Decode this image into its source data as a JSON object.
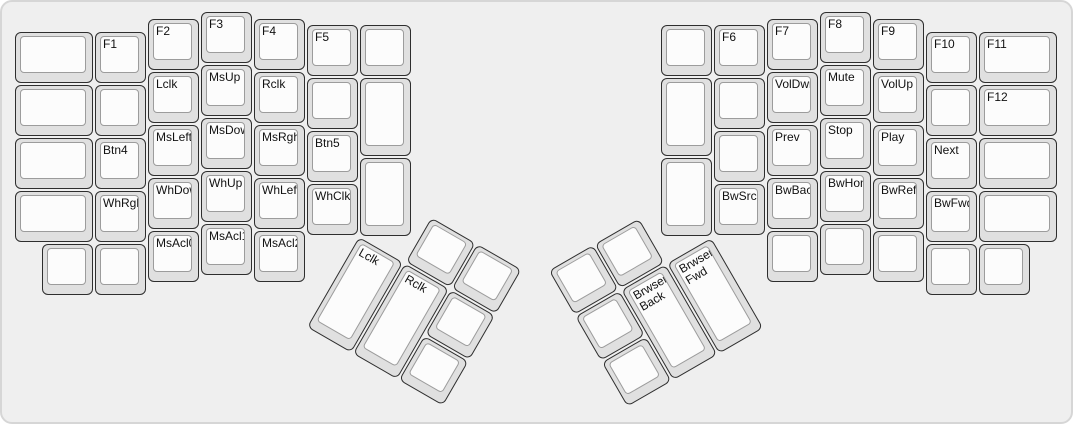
{
  "keyboard_name": "ergodox-layout",
  "layer_description": "Function, mouse, media and browser keys layer",
  "colors": {
    "canvas_bg": "#efefef",
    "canvas_border": "#d6d6d6",
    "cap_side": "#e0e0e0",
    "cap_border": "#2e2e2e",
    "cap_top": "#fcfcfc",
    "cap_top_border": "#9c9c9c",
    "label": "#111111"
  },
  "left_main": [
    {
      "label": "",
      "x": 13,
      "y": 30,
      "w": 78,
      "h": 51
    },
    {
      "label": "F1",
      "x": 93,
      "y": 30,
      "w": 51,
      "h": 51
    },
    {
      "label": "F2",
      "x": 146,
      "y": 17,
      "w": 51,
      "h": 51
    },
    {
      "label": "F3",
      "x": 199,
      "y": 10,
      "w": 51,
      "h": 51
    },
    {
      "label": "F4",
      "x": 252,
      "y": 17,
      "w": 51,
      "h": 51
    },
    {
      "label": "F5",
      "x": 305,
      "y": 23,
      "w": 51,
      "h": 51
    },
    {
      "label": "",
      "x": 358,
      "y": 23,
      "w": 51,
      "h": 51
    },
    {
      "label": "",
      "x": 13,
      "y": 83,
      "w": 78,
      "h": 51
    },
    {
      "label": "",
      "x": 93,
      "y": 83,
      "w": 51,
      "h": 51
    },
    {
      "label": "Lclk",
      "x": 146,
      "y": 70,
      "w": 51,
      "h": 51
    },
    {
      "label": "MsUp",
      "x": 199,
      "y": 63,
      "w": 51,
      "h": 51
    },
    {
      "label": "Rclk",
      "x": 252,
      "y": 70,
      "w": 51,
      "h": 51
    },
    {
      "label": "",
      "x": 305,
      "y": 76,
      "w": 51,
      "h": 51
    },
    {
      "label": "",
      "x": 358,
      "y": 76,
      "w": 51,
      "h": 78
    },
    {
      "label": "",
      "x": 13,
      "y": 136,
      "w": 78,
      "h": 51
    },
    {
      "label": "Btn4",
      "x": 93,
      "y": 136,
      "w": 51,
      "h": 51
    },
    {
      "label": "MsLeft",
      "x": 146,
      "y": 123,
      "w": 51,
      "h": 51
    },
    {
      "label": "MsDown",
      "x": 199,
      "y": 116,
      "w": 51,
      "h": 51
    },
    {
      "label": "MsRght",
      "x": 252,
      "y": 123,
      "w": 51,
      "h": 51
    },
    {
      "label": "Btn5",
      "x": 305,
      "y": 129,
      "w": 51,
      "h": 51
    },
    {
      "label": "",
      "x": 13,
      "y": 189,
      "w": 78,
      "h": 51
    },
    {
      "label": "WhRght",
      "x": 93,
      "y": 189,
      "w": 51,
      "h": 51
    },
    {
      "label": "WhDown",
      "x": 146,
      "y": 176,
      "w": 51,
      "h": 51
    },
    {
      "label": "WhUp",
      "x": 199,
      "y": 169,
      "w": 51,
      "h": 51
    },
    {
      "label": "WhLeft",
      "x": 252,
      "y": 176,
      "w": 51,
      "h": 51
    },
    {
      "label": "WhClk",
      "x": 305,
      "y": 182,
      "w": 51,
      "h": 51
    },
    {
      "label": "",
      "x": 358,
      "y": 156,
      "w": 51,
      "h": 78
    },
    {
      "label": "",
      "x": 40,
      "y": 242,
      "w": 51,
      "h": 51
    },
    {
      "label": "",
      "x": 93,
      "y": 242,
      "w": 51,
      "h": 51
    },
    {
      "label": "MsAcl0",
      "x": 146,
      "y": 229,
      "w": 51,
      "h": 51
    },
    {
      "label": "MsAcl1",
      "x": 199,
      "y": 222,
      "w": 51,
      "h": 51
    },
    {
      "label": "MsAcl2",
      "x": 252,
      "y": 229,
      "w": 51,
      "h": 51
    }
  ],
  "right_main": [
    {
      "label": "",
      "x": 659,
      "y": 23,
      "w": 51,
      "h": 51
    },
    {
      "label": "F6",
      "x": 712,
      "y": 23,
      "w": 51,
      "h": 51
    },
    {
      "label": "F7",
      "x": 765,
      "y": 17,
      "w": 51,
      "h": 51
    },
    {
      "label": "F8",
      "x": 818,
      "y": 10,
      "w": 51,
      "h": 51
    },
    {
      "label": "F9",
      "x": 871,
      "y": 17,
      "w": 51,
      "h": 51
    },
    {
      "label": "F10",
      "x": 924,
      "y": 30,
      "w": 51,
      "h": 51
    },
    {
      "label": "F11",
      "x": 977,
      "y": 30,
      "w": 78,
      "h": 51
    },
    {
      "label": "",
      "x": 659,
      "y": 76,
      "w": 51,
      "h": 78
    },
    {
      "label": "",
      "x": 712,
      "y": 76,
      "w": 51,
      "h": 51
    },
    {
      "label": "VolDwn",
      "x": 765,
      "y": 70,
      "w": 51,
      "h": 51
    },
    {
      "label": "Mute",
      "x": 818,
      "y": 63,
      "w": 51,
      "h": 51
    },
    {
      "label": "VolUp",
      "x": 871,
      "y": 70,
      "w": 51,
      "h": 51
    },
    {
      "label": "",
      "x": 924,
      "y": 83,
      "w": 51,
      "h": 51
    },
    {
      "label": "F12",
      "x": 977,
      "y": 83,
      "w": 78,
      "h": 51
    },
    {
      "label": "",
      "x": 712,
      "y": 129,
      "w": 51,
      "h": 51
    },
    {
      "label": "Prev",
      "x": 765,
      "y": 123,
      "w": 51,
      "h": 51
    },
    {
      "label": "Stop",
      "x": 818,
      "y": 116,
      "w": 51,
      "h": 51
    },
    {
      "label": "Play",
      "x": 871,
      "y": 123,
      "w": 51,
      "h": 51
    },
    {
      "label": "Next",
      "x": 924,
      "y": 136,
      "w": 51,
      "h": 51
    },
    {
      "label": "",
      "x": 977,
      "y": 136,
      "w": 78,
      "h": 51
    },
    {
      "label": "",
      "x": 659,
      "y": 156,
      "w": 51,
      "h": 78
    },
    {
      "label": "BwSrch",
      "x": 712,
      "y": 182,
      "w": 51,
      "h": 51
    },
    {
      "label": "BwBack",
      "x": 765,
      "y": 176,
      "w": 51,
      "h": 51
    },
    {
      "label": "BwHome",
      "x": 818,
      "y": 169,
      "w": 51,
      "h": 51
    },
    {
      "label": "BwRefr",
      "x": 871,
      "y": 176,
      "w": 51,
      "h": 51
    },
    {
      "label": "BwFwd",
      "x": 924,
      "y": 189,
      "w": 51,
      "h": 51
    },
    {
      "label": "",
      "x": 977,
      "y": 189,
      "w": 78,
      "h": 51
    },
    {
      "label": "",
      "x": 765,
      "y": 229,
      "w": 51,
      "h": 51
    },
    {
      "label": "",
      "x": 818,
      "y": 222,
      "w": 51,
      "h": 51
    },
    {
      "label": "",
      "x": 871,
      "y": 229,
      "w": 51,
      "h": 51
    },
    {
      "label": "",
      "x": 924,
      "y": 242,
      "w": 51,
      "h": 51
    },
    {
      "label": "",
      "x": 977,
      "y": 242,
      "w": 51,
      "h": 51
    }
  ],
  "left_thumb": {
    "cx": 357,
    "cy": 235,
    "rotation": 30,
    "keys": [
      {
        "label": "",
        "x": 53,
        "y": -53,
        "w": 51,
        "h": 51
      },
      {
        "label": "",
        "x": 106,
        "y": -53,
        "w": 51,
        "h": 51
      },
      {
        "label": "Lclk",
        "x": 0,
        "y": 0,
        "w": 51,
        "h": 104
      },
      {
        "label": "Rclk",
        "x": 53,
        "y": 0,
        "w": 51,
        "h": 104
      },
      {
        "label": "",
        "x": 106,
        "y": 0,
        "w": 51,
        "h": 51
      },
      {
        "label": "",
        "x": 106,
        "y": 53,
        "w": 51,
        "h": 51
      }
    ]
  },
  "right_thumb": {
    "cx": 711,
    "cy": 235,
    "rotation": -30,
    "keys": [
      {
        "label": "",
        "x": -159,
        "y": -53,
        "w": 51,
        "h": 51
      },
      {
        "label": "",
        "x": -106,
        "y": -53,
        "w": 51,
        "h": 51
      },
      {
        "label": "",
        "x": -159,
        "y": 0,
        "w": 51,
        "h": 51
      },
      {
        "label": "Brwser Back",
        "x": -106,
        "y": 0,
        "w": 51,
        "h": 104
      },
      {
        "label": "Brwser Fwd",
        "x": -53,
        "y": 0,
        "w": 51,
        "h": 104
      },
      {
        "label": "",
        "x": -159,
        "y": 53,
        "w": 51,
        "h": 51
      }
    ]
  }
}
